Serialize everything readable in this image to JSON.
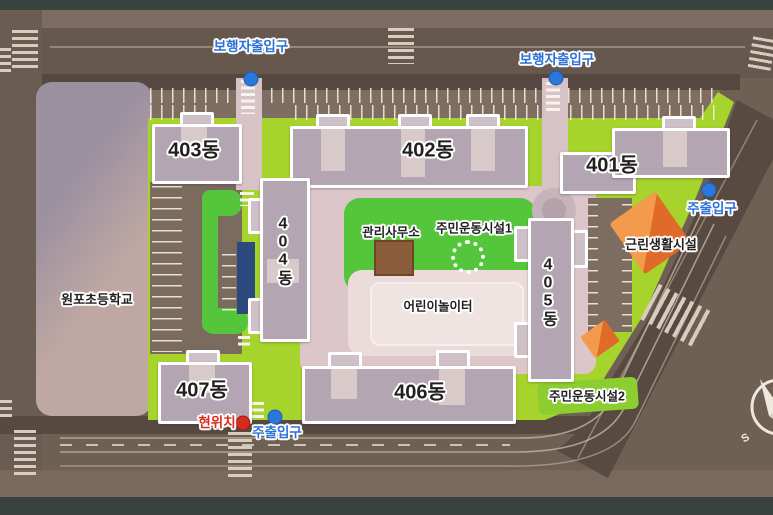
{
  "map": {
    "school": "원포초등학교",
    "buildings": [
      {
        "id": "401",
        "label": "401동"
      },
      {
        "id": "402",
        "label": "402동"
      },
      {
        "id": "403",
        "label": "403동"
      },
      {
        "id": "404",
        "label": "404동"
      },
      {
        "id": "405",
        "label": "405동"
      },
      {
        "id": "406",
        "label": "406동"
      },
      {
        "id": "407",
        "label": "407동"
      }
    ],
    "facilities": {
      "management_office": "관리사무소",
      "sports_facility_1": "주민운동시설1",
      "sports_facility_2": "주민운동시설2",
      "children_playground": "어린이놀이터",
      "neighborhood_facility": "근린생활시설"
    },
    "markers": {
      "pedestrian_entrance": "보행자출입구",
      "main_entrance": "주출입구",
      "current_location": "현위치"
    },
    "compass": {
      "south": "S"
    },
    "colors": {
      "entrance_text": "#2a72d9",
      "current_location_text": "#df2a1e",
      "lawn": "#a6d42c",
      "inner_green": "#55c53c",
      "road": "#6f6054",
      "building": "#b3a5b1",
      "orange_facility": "#ef8f42"
    }
  }
}
